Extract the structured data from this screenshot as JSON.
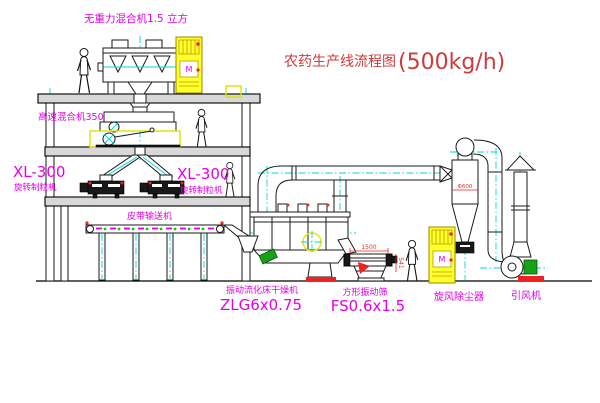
{
  "diagram": {
    "title": "农药生产线流程图",
    "capacity": "(500kg/h)"
  },
  "labels": {
    "gravity_mixer": "无重力混合机1.5 立方",
    "high_speed_mixer": "高速混合机350",
    "granulator_left_model": "XL-300",
    "granulator_left_name": "旋转制粒机",
    "granulator_right_model": "XL-300",
    "granulator_right_name": "旋转制粒机",
    "belt_conveyor": "皮带输送机",
    "dryer_name": "振动流化床干燥机",
    "dryer_model": "ZLG6x0.75",
    "screen_name": "方形振动筛",
    "screen_model": "FS0.6x1.5",
    "cyclone": "旋风除尘器",
    "induced_fan": "引风机"
  },
  "dimensions": {
    "screen_length": "1500",
    "screen_height": "541",
    "cyclone_diameter": "Φ600"
  },
  "cabinet": {
    "panel_symbol": "M"
  },
  "colors": {
    "label_magenta": "#e400e4",
    "title_red": "#cd3b3b",
    "annotation_red": "#ee2222",
    "centerline_cyan": "#00d8d8",
    "cabinet_yellow": "#ffff29",
    "motor_green": "#18a018"
  }
}
